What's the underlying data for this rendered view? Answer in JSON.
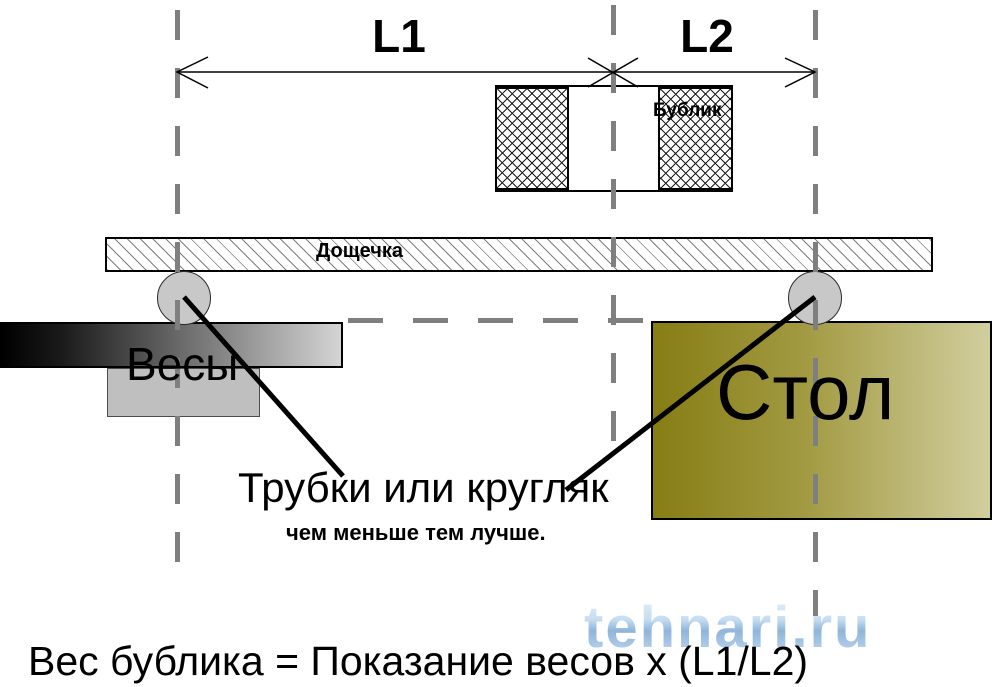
{
  "diagram": {
    "dimension_labels": {
      "l1": "L1",
      "l2": "L2"
    },
    "bagel_label": "Бублик",
    "plank_label": "Дощечка",
    "scale_label": "Весы",
    "table_label": "Стол",
    "tubes_label": "Трубки или кругляк",
    "tubes_note": "чем меньше тем лучше.",
    "formula": "Вес бублика = Показание весов x (L1/L2)",
    "watermark": "tehnari.ru",
    "colors": {
      "dash_gray": "#7f7f7f",
      "line_black": "#000000",
      "table_dark": "#867d14",
      "table_light": "#d1ce9e",
      "scale_dark": "#000000",
      "scale_light": "#d4d4d4",
      "scale_base_gray": "#bfbfbf",
      "tube_fill": "#c8c8c8",
      "watermark_blue": "#a6c6e6"
    }
  }
}
